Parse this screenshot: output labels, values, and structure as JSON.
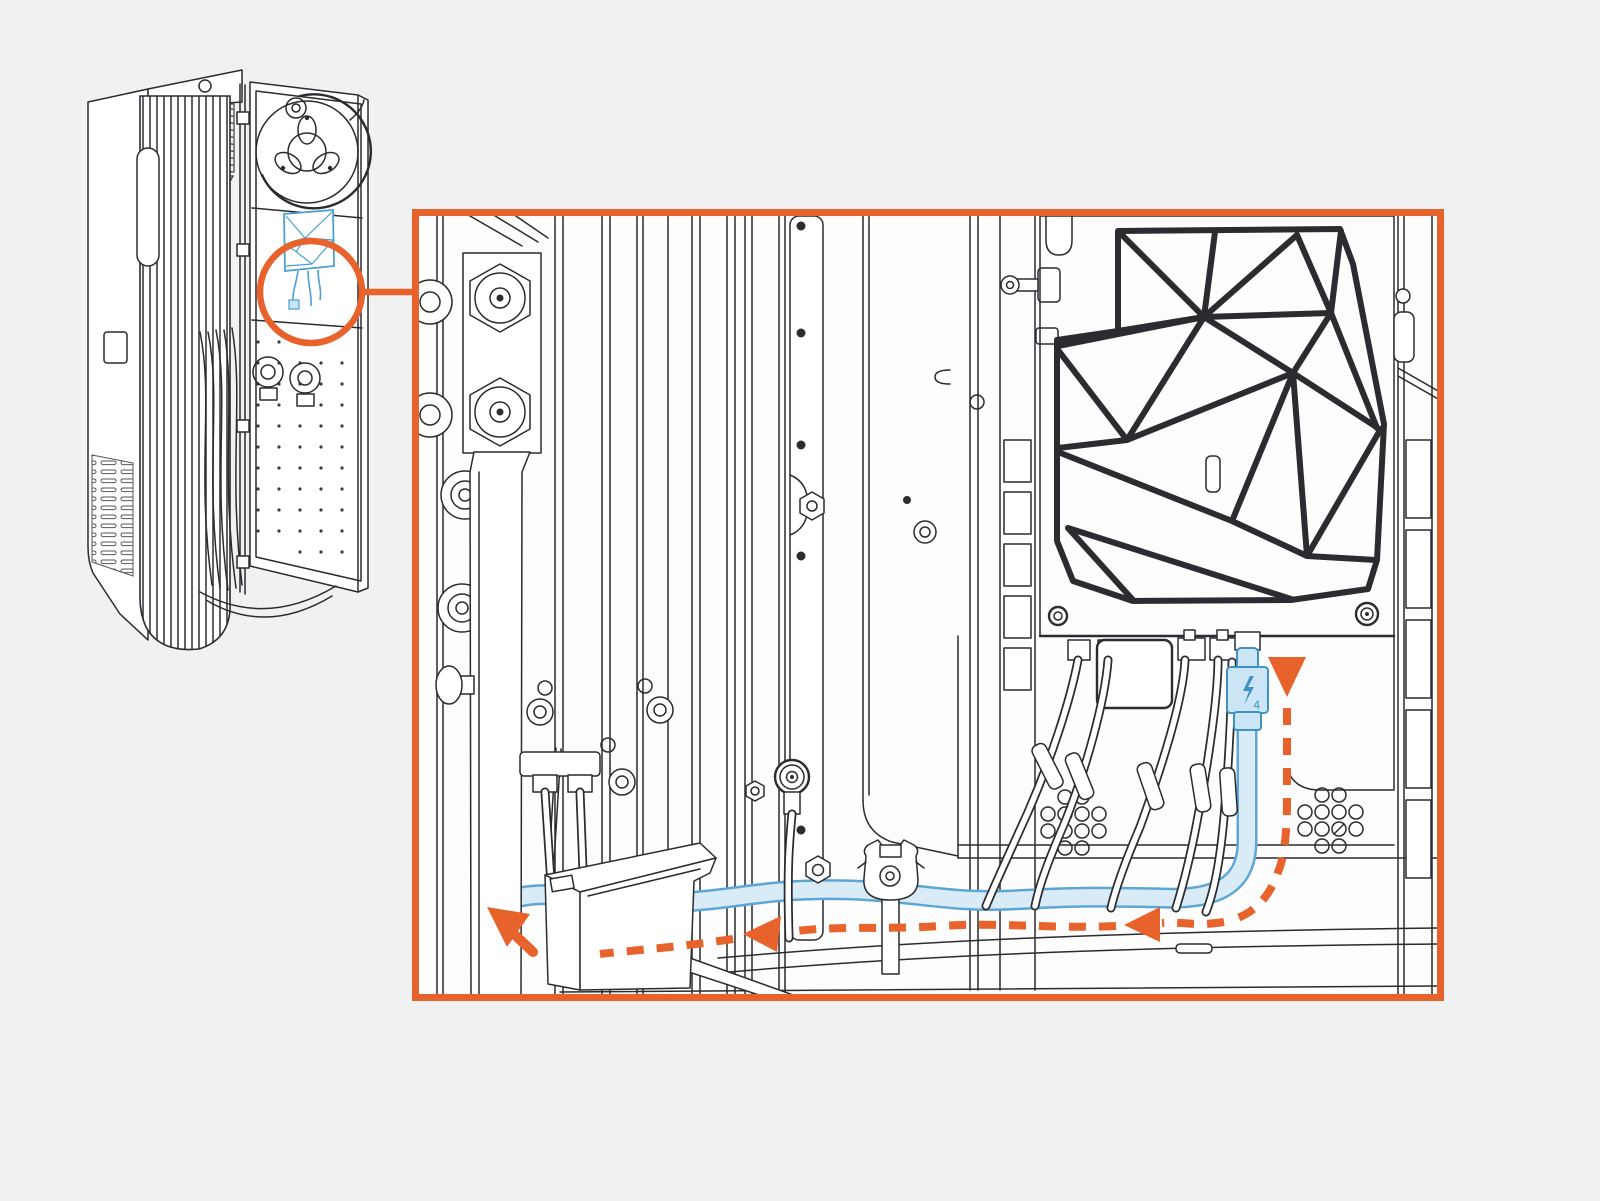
{
  "scene": {
    "background": "#F1F1F2",
    "detail_panel_fill": "#FDFDFD",
    "description": "Service illustration: appliance tower with open door, circular callout magnifying the Thunderbolt cable routing inside the chassis"
  },
  "colors": {
    "line": "#2B2B30",
    "line_soft": "#85858C",
    "accent_orange": "#E8622C",
    "cable_blue_stroke": "#5EA7D4",
    "cable_blue_fill": "#D9EBF7",
    "component_blue_stroke": "#3F93C4",
    "component_blue_fill": "#CBE5F4",
    "highlight_blue": "#4BA0D1"
  },
  "detail": {
    "connector_label": "4"
  },
  "icons": {
    "thunderbolt": "lightning-bolt-glyph",
    "route_start_arrow": "down-triangle",
    "route_mid_arrow": "left-triangle",
    "route_end_arrow": "up-left-cursor-arrow"
  }
}
